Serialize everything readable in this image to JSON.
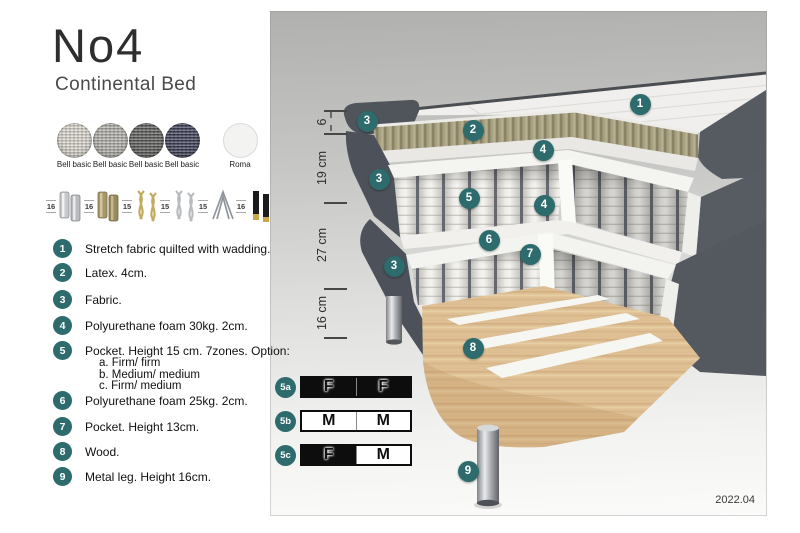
{
  "title": "No4",
  "subtitle": "Continental Bed",
  "version": "2022.04",
  "colors": {
    "teal": "#2d6b6d",
    "panel_gray": "#b0b0ae"
  },
  "fabrics": [
    {
      "line1": "Bell basic",
      "line2": "MCD36",
      "color": "#ddd9d0",
      "style": "woven"
    },
    {
      "line1": "Bell basic",
      "line2": "MCD32",
      "color": "#b4b2ad",
      "style": "woven"
    },
    {
      "line1": "Bell basic",
      "line2": "MCD43",
      "color": "#5e5e5c",
      "style": "woven"
    },
    {
      "line1": "Bell basic",
      "line2": "MCD74",
      "color": "#3e4059",
      "style": "woven"
    },
    {
      "line1": "Roma",
      "line2": "stretch fabric",
      "color": "#f3f3f1",
      "style": "plain"
    }
  ],
  "legs": [
    {
      "height": "16",
      "type": "cylinder-chrome"
    },
    {
      "height": "16",
      "type": "cylinder-brass"
    },
    {
      "height": "15",
      "type": "twist-gold"
    },
    {
      "height": "15",
      "type": "twist-silver"
    },
    {
      "height": "15",
      "type": "hairpin"
    },
    {
      "height": "16",
      "type": "black-gold"
    }
  ],
  "features": [
    {
      "num": "1",
      "text": "Stretch fabric quilted with wadding."
    },
    {
      "num": "2",
      "text": "Latex. 4cm."
    },
    {
      "num": "3",
      "text": "Fabric."
    },
    {
      "num": "4",
      "text": "Polyurethane foam 30kg. 2cm."
    },
    {
      "num": "5",
      "text": "Pocket. Height 15 cm. 7zones. Option:",
      "options": [
        "a. Firm/ firm",
        "b. Medium/ medium",
        "c. Firm/ medium"
      ]
    },
    {
      "num": "6",
      "text": "Polyurethane foam 25kg. 2cm."
    },
    {
      "num": "7",
      "text": "Pocket. Height 13cm."
    },
    {
      "num": "8",
      "text": "Wood."
    },
    {
      "num": "9",
      "text": "Metal leg. Height 16cm."
    }
  ],
  "dimensions": [
    {
      "label": "6",
      "from": 110,
      "to": 133
    },
    {
      "label": "19 cm",
      "from": 133,
      "to": 202
    },
    {
      "label": "27 cm",
      "from": 202,
      "to": 288
    },
    {
      "label": "16 cm",
      "from": 288,
      "to": 337
    }
  ],
  "callouts": [
    {
      "label": "1",
      "x": 640,
      "y": 104
    },
    {
      "label": "2",
      "x": 473,
      "y": 130
    },
    {
      "label": "3",
      "x": 367,
      "y": 121
    },
    {
      "label": "3",
      "x": 379,
      "y": 179
    },
    {
      "label": "3",
      "x": 394,
      "y": 266
    },
    {
      "label": "4",
      "x": 543,
      "y": 150
    },
    {
      "label": "4",
      "x": 544,
      "y": 205
    },
    {
      "label": "5",
      "x": 469,
      "y": 198
    },
    {
      "label": "6",
      "x": 489,
      "y": 240
    },
    {
      "label": "7",
      "x": 530,
      "y": 254
    },
    {
      "label": "8",
      "x": 473,
      "y": 348
    },
    {
      "label": "9",
      "x": 468,
      "y": 471
    }
  ],
  "firmness_rows": [
    {
      "id": "5a",
      "cells": [
        {
          "letter": "F",
          "bg": "black"
        },
        {
          "letter": "F",
          "bg": "black"
        }
      ]
    },
    {
      "id": "5b",
      "cells": [
        {
          "letter": "M",
          "bg": "white"
        },
        {
          "letter": "M",
          "bg": "white"
        }
      ]
    },
    {
      "id": "5c",
      "cells": [
        {
          "letter": "F",
          "bg": "black"
        },
        {
          "letter": "M",
          "bg": "white"
        }
      ]
    }
  ]
}
